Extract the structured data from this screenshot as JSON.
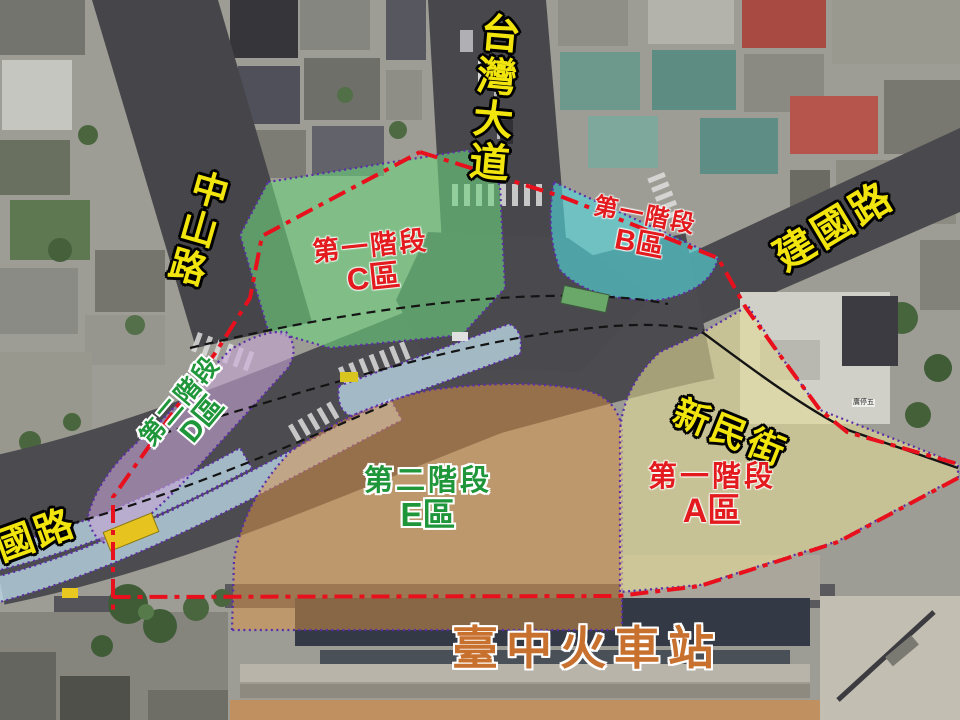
{
  "map": {
    "road_labels": {
      "taiwan_boulevard": "台灣大道",
      "zhongshan_road": "中山路",
      "jianguo_road": "建國路",
      "jianguo_road_partial": "國路",
      "xinmin_street": "新民街"
    },
    "station_label": "臺中火車站",
    "zones": {
      "A": {
        "phase": "第一階段",
        "area": "A區"
      },
      "B": {
        "phase": "第一階段",
        "area": "B區"
      },
      "C": {
        "phase": "第一階段",
        "area": "C區"
      },
      "D": {
        "phase": "第二階段",
        "area": "D區"
      },
      "E": {
        "phase": "第二階段",
        "area": "E區"
      }
    },
    "small_labels": {
      "parking": "廣停五"
    },
    "colors": {
      "boundary_red": "#e8101c",
      "zone_border_purple": "#5b2da8",
      "zone_a_fill": "#e6dc96",
      "zone_b_fill": "#52d8dc",
      "zone_c_fill": "#6ed47e",
      "zone_d_fill": "#c7a3d6",
      "zone_e_fill": "#de9446",
      "bus_band_blue": "#b9d6e4",
      "road_label_yellow": "#f2e50d",
      "phase1_text_red": "#e31b1e",
      "phase2_text_green": "#1e9639",
      "station_text_orange": "#c8702e"
    }
  }
}
